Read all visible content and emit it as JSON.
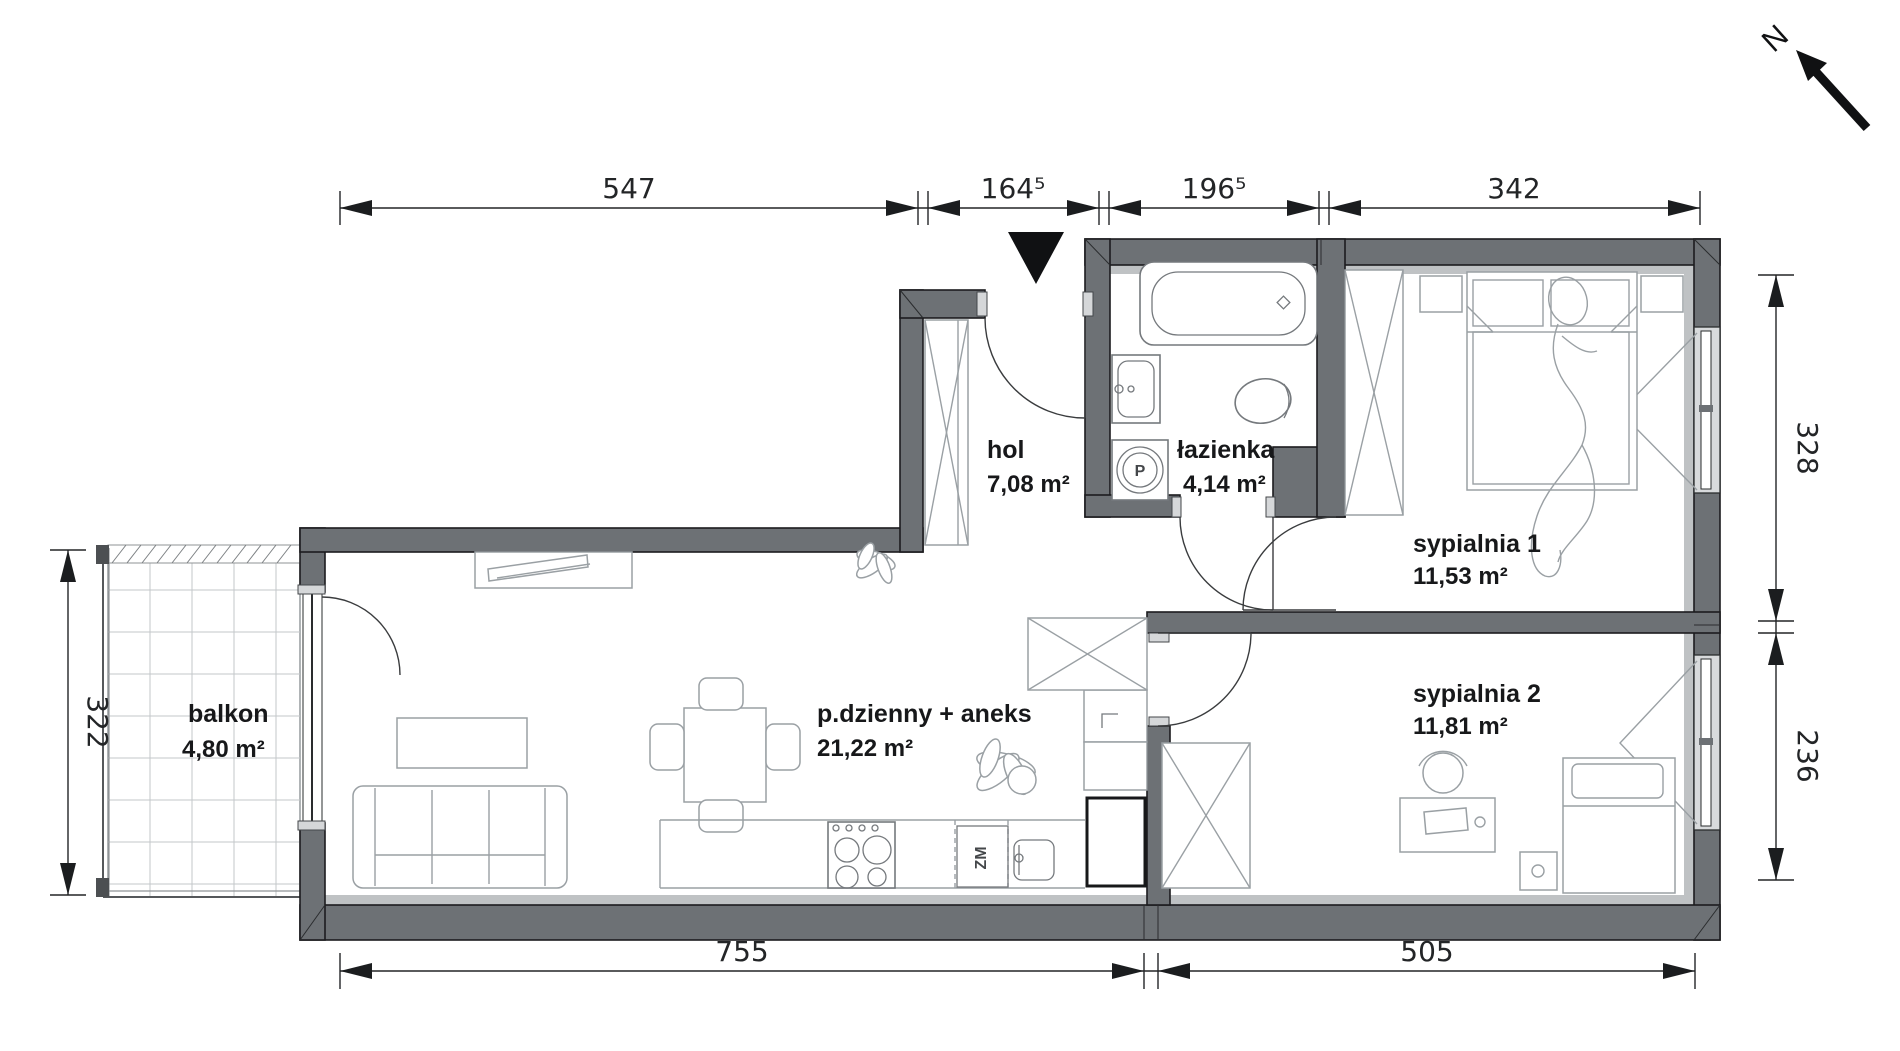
{
  "rooms": {
    "hol": {
      "name": "hol",
      "area": "7,08 m²"
    },
    "lazienka": {
      "name": "łazienka",
      "area": "4,14 m²"
    },
    "sypialnia1": {
      "name": "sypialnia 1",
      "area": "11,53 m²"
    },
    "sypialnia2": {
      "name": "sypialnia 2",
      "area": "11,81 m²"
    },
    "pdzienny": {
      "name": "p.dzienny + aneks",
      "area": "21,22 m²"
    },
    "balkon": {
      "name": "balkon",
      "area": "4,80 m²"
    }
  },
  "dims": {
    "top1": "547",
    "top2": "164⁵",
    "top3": "196⁵",
    "top4": "342",
    "right1": "328",
    "right2": "236",
    "left1": "322",
    "bottom1": "755",
    "bottom2": "505"
  },
  "symbols": {
    "north": "N",
    "washer": "P",
    "dishwasher": "ZM"
  },
  "colors": {
    "wall": "#6d7175",
    "wall_light": "#bfc2c4",
    "accent_black": "#101113",
    "furniture": "#9aa0a4"
  }
}
